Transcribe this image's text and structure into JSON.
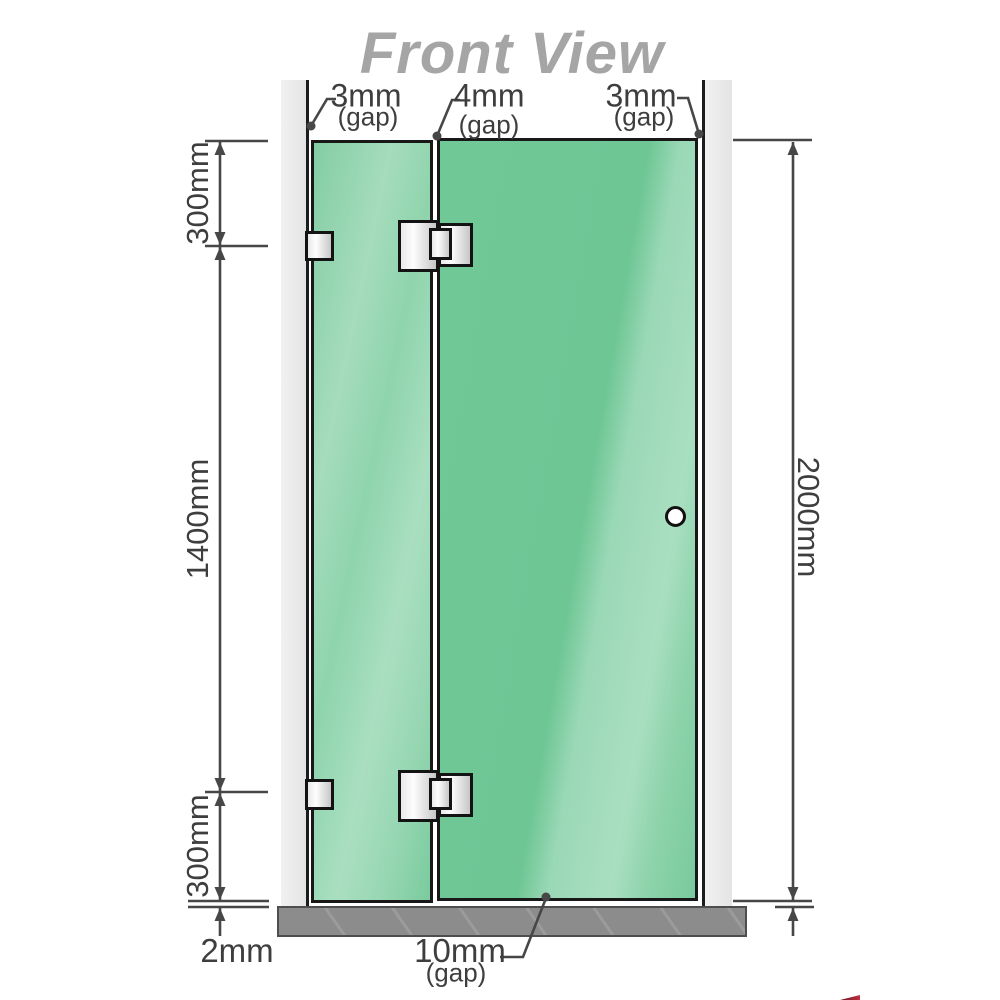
{
  "title": "Front View",
  "top_gaps": {
    "left": {
      "value": "3mm",
      "label": "(gap)"
    },
    "middle": {
      "value": "4mm",
      "label": "(gap)"
    },
    "right": {
      "value": "3mm",
      "label": "(gap)"
    }
  },
  "side_dimensions": {
    "left_top": "300mm",
    "left_middle": "1400mm",
    "left_bottom": "300mm",
    "right_total": "2000mm"
  },
  "bottom_dimensions": {
    "floor_clearance": "2mm",
    "door_floor_gap": {
      "value": "10mm",
      "label": "(gap)"
    }
  },
  "colors": {
    "glass_green": "#74c797",
    "glass_sheen": "#a9dfc1",
    "wall_gray": "#eaeaea",
    "floor_gray": "#8c8c8c",
    "dimension_line": "#474747",
    "title_gray": "#a5a5a5",
    "hardware_metal": "#e9e9e9"
  }
}
